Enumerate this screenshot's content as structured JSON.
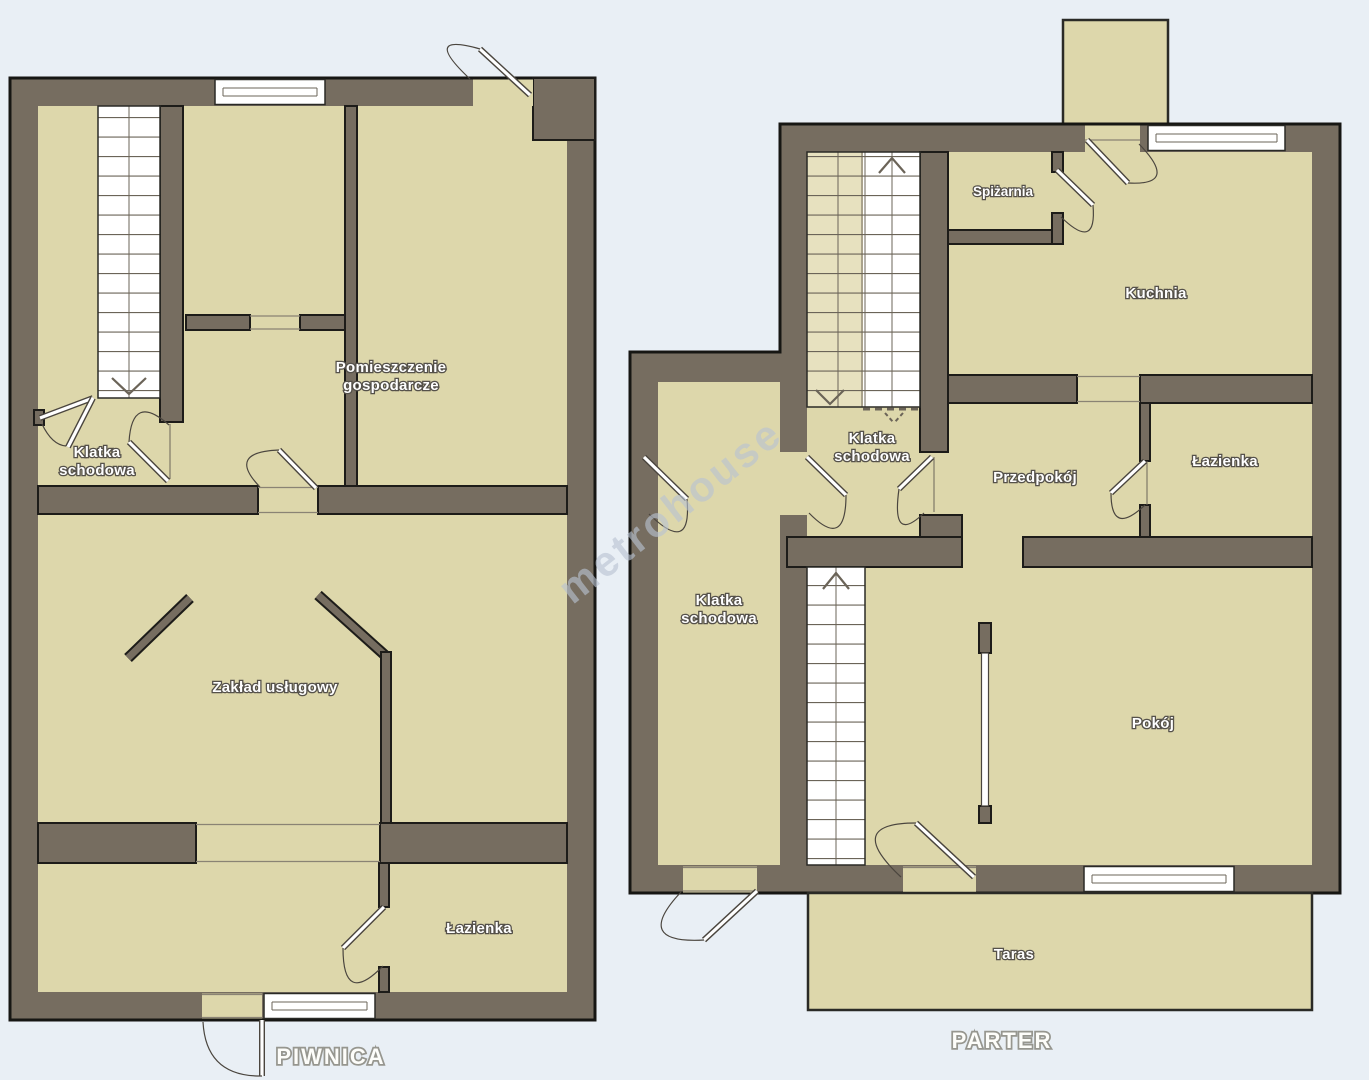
{
  "watermark": "metrohouse",
  "colors": {
    "background": "#e9eff5",
    "room_fill": "#ddd7ab",
    "wall_fill": "#766d60",
    "outline": "#1d1c19",
    "window_white": "#ffffff",
    "stair_light": "#e7e1bf",
    "label_text": "#ffffff",
    "label_outline": "#55514a",
    "title_text": "#fdfdfa",
    "title_outline": "#96968f",
    "watermark_color": "#b9c3d2"
  },
  "plans": {
    "piwnica": {
      "title": "PIWNICA",
      "rooms": {
        "klatka_schodowa": [
          "Klatka",
          "schodowa"
        ],
        "pomieszczenie_gospodarcze": [
          "Pomieszczenie",
          "gospodarcze"
        ],
        "zaklad_uslugowy": "Zakład usługowy",
        "lazienka": "Łazienka"
      }
    },
    "parter": {
      "title": "PARTER",
      "rooms": {
        "spizarnia": "Spiżarnia",
        "kuchnia": "Kuchnia",
        "klatka_schodowa_gorna": [
          "Klatka",
          "schodowa"
        ],
        "przedpokoj": "Przedpokój",
        "lazienka": "Łazienka",
        "klatka_schodowa_dolna": [
          "Klatka",
          "schodowa"
        ],
        "pokoj": "Pokój",
        "taras": "Taras"
      }
    }
  }
}
